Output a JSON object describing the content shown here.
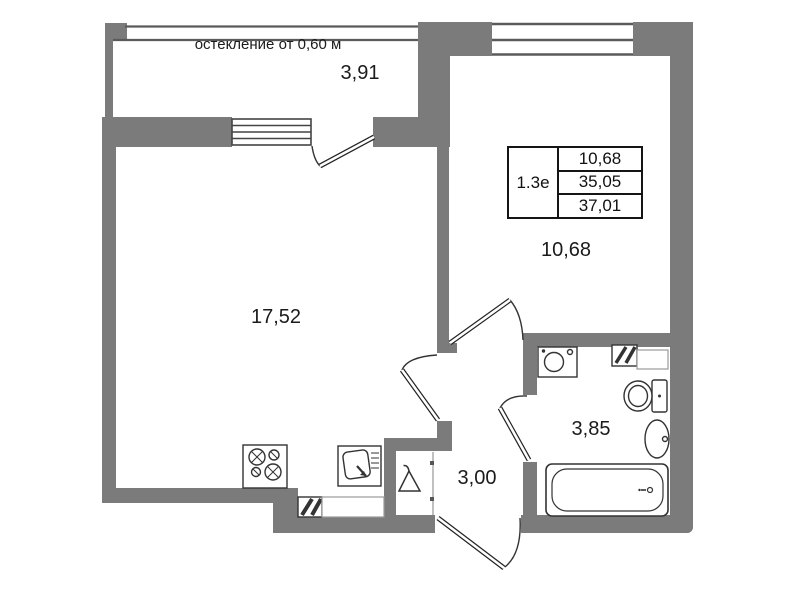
{
  "floor_plan": {
    "glazing_note": "остекление от 0,60 м",
    "unit_stamp": {
      "unit_type": "1.3е",
      "row_values": [
        "10,68",
        "35,05",
        "37,01"
      ]
    },
    "room_areas": {
      "balcony": "3,91",
      "living_kitchen": "17,52",
      "bedroom": "10,68",
      "bathroom": "3,85",
      "hallway": "3,00"
    },
    "colors": {
      "wall": "#7b7b7b",
      "outline": "#333333",
      "background": "#ffffff"
    },
    "fixtures": {
      "stove": "stove-icon",
      "kitchen_sink": "kitchen-sink-icon",
      "washing_machine": "washing-machine-icon",
      "toilet": "toilet-icon",
      "wash_basin": "basin-icon",
      "bathtub": "bathtub-icon",
      "coat_hanger": "hanger-icon",
      "vent_kitchen": "vent-hatch-icon",
      "vent_bathroom": "vent-hatch-icon"
    }
  }
}
